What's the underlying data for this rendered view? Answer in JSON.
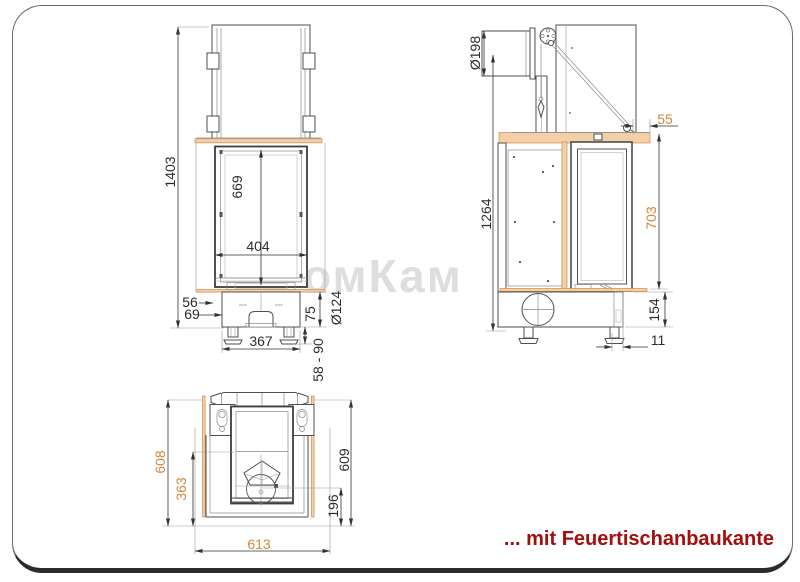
{
  "caption": "... mit Feuertischanbaukante",
  "watermark": "омКам",
  "colors": {
    "dimension_orange": "#d4863c",
    "caption_red": "#a30e0e",
    "table_fill": "#f3d0a7",
    "line": "#3d3d3d"
  },
  "dims": {
    "front_total_height": "1403",
    "front_firebox_height": "669",
    "front_firebox_width": "404",
    "front_top_offset": "56",
    "front_base_offset": "69",
    "front_base_width": "367",
    "front_base_height": "75",
    "front_connector_dia": "Ø124",
    "front_leg_range": "58 - 90",
    "side_flue_dia": "Ø198",
    "side_table_edge": "55",
    "side_total_height": "1264",
    "side_glass_height": "703",
    "side_base_height": "154",
    "side_leg_offset": "11",
    "top_table_depth": "608",
    "top_inner_depth": "363",
    "top_unit_depth": "609",
    "top_fan_offset": "196",
    "top_table_width": "613"
  }
}
